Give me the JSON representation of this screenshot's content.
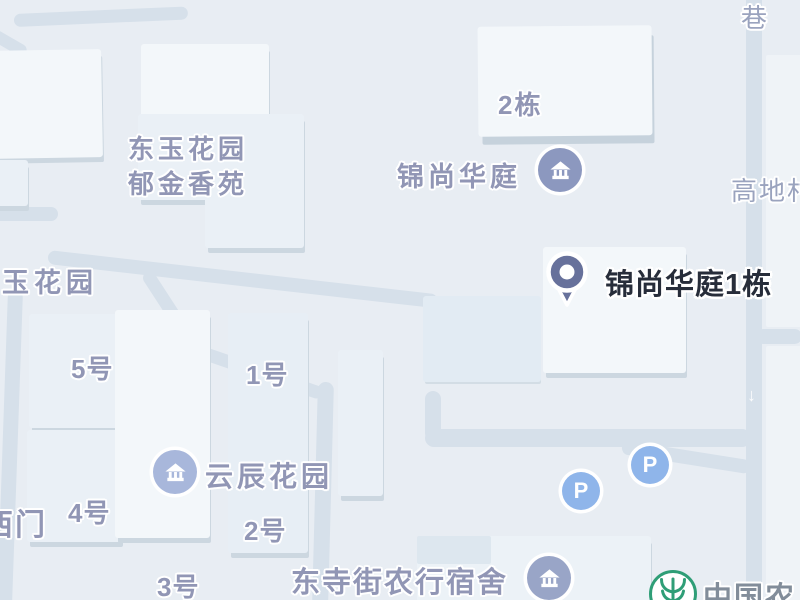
{
  "map": {
    "selected_poi": {
      "label": "锦尚华庭1栋"
    },
    "estates": {
      "topleft_line1": "东玉花园",
      "topleft_line2": "郁金香苑",
      "left_edge_cut": "玉花园",
      "jinshang": "锦尚华庭",
      "yunchen": "云辰花园",
      "dongsi_dorm": "东寺街农行宿舍",
      "west_gate": "西门",
      "bank_partial": "中国农"
    },
    "buildings": {
      "dong2": "2栋",
      "hao1": "1号",
      "hao2": "2号",
      "hao3": "3号",
      "hao4": "4号",
      "hao5": "5号"
    },
    "roads": {
      "xiang": "巷",
      "gaodicun": "高地村"
    },
    "icons": {
      "parking_letter": "P",
      "oneway_arrow": "↓"
    },
    "colors": {
      "background": "#e8edf3",
      "road": "#d6e0ea",
      "building_face": "#eaf0f6",
      "building_shadow": "#ccd7e0",
      "poi_label": "#9196b5",
      "road_label": "#9aa3be",
      "selected_label": "#272d3a",
      "pin": "#67719b",
      "estate_icon": "#8c98bf",
      "estate_icon_light": "#a8b7db",
      "parking_icon": "#8fb5ea",
      "bank_green": "#2f9e77"
    }
  }
}
